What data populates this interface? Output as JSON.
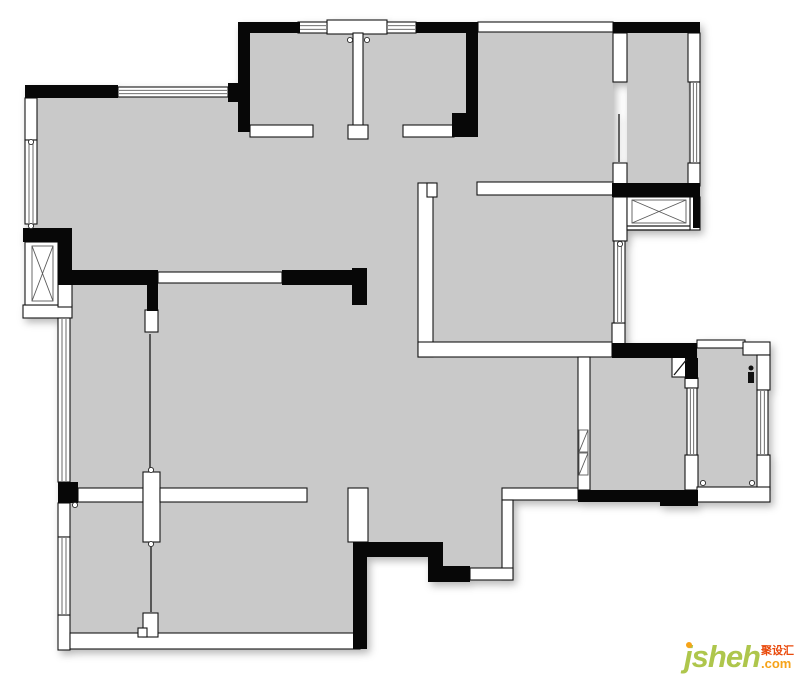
{
  "watermark": {
    "brand": "jsheh",
    "cjk": "聚设汇",
    "tld": ".com",
    "brand_color": "#aec64c",
    "cjk_color": "#e94a0c",
    "tld_color": "#f6a318",
    "dot_color": "#f6a318"
  },
  "floorplan": {
    "canvas": {
      "w": 800,
      "h": 674
    },
    "colors": {
      "floor": "#c9c9c9",
      "wall_black": "#070707",
      "wall_white": "#ffffff",
      "outline": "#161616"
    },
    "floors": [
      [
        250,
        33,
        216,
        104
      ],
      [
        478,
        30,
        135,
        153
      ],
      [
        627,
        33,
        61,
        152
      ],
      [
        31,
        92,
        582,
        193
      ],
      [
        70,
        285,
        297,
        350
      ],
      [
        367,
        285,
        211,
        215
      ],
      [
        367,
        500,
        76,
        42
      ],
      [
        443,
        500,
        59,
        68
      ],
      [
        578,
        285,
        35,
        72
      ],
      [
        590,
        357,
        107,
        133
      ],
      [
        698,
        348,
        59,
        139
      ]
    ],
    "white_walls": [
      [
        327,
        20,
        60,
        14
      ],
      [
        353,
        33,
        10,
        94
      ],
      [
        348,
        125,
        20,
        14
      ],
      [
        250,
        125,
        63,
        12
      ],
      [
        403,
        125,
        51,
        12
      ],
      [
        478,
        22,
        135,
        10
      ],
      [
        613,
        33,
        14,
        49
      ],
      [
        613,
        163,
        14,
        23
      ],
      [
        688,
        33,
        12,
        49
      ],
      [
        688,
        163,
        12,
        23
      ],
      [
        613,
        197,
        14,
        44
      ],
      [
        690,
        197,
        10,
        33
      ],
      [
        612,
        323,
        13,
        21
      ],
      [
        477,
        182,
        136,
        13
      ],
      [
        418,
        183,
        15,
        174
      ],
      [
        427,
        183,
        10,
        14
      ],
      [
        418,
        342,
        194,
        15
      ],
      [
        25,
        98,
        12,
        42
      ],
      [
        23,
        305,
        49,
        13
      ],
      [
        58,
        277,
        14,
        30
      ],
      [
        58,
        503,
        12,
        34
      ],
      [
        58,
        615,
        12,
        35
      ],
      [
        70,
        633,
        290,
        16
      ],
      [
        78,
        488,
        65,
        14
      ],
      [
        143,
        472,
        17,
        70
      ],
      [
        145,
        310,
        13,
        22
      ],
      [
        160,
        488,
        147,
        14
      ],
      [
        158,
        272,
        124,
        11
      ],
      [
        143,
        613,
        15,
        24
      ],
      [
        138,
        628,
        9,
        9
      ],
      [
        348,
        488,
        20,
        54
      ],
      [
        502,
        488,
        76,
        12
      ],
      [
        502,
        500,
        11,
        80
      ],
      [
        470,
        568,
        43,
        12
      ],
      [
        578,
        357,
        12,
        133
      ],
      [
        697,
        340,
        48,
        8
      ],
      [
        743,
        342,
        27,
        13
      ],
      [
        757,
        355,
        13,
        35
      ],
      [
        757,
        455,
        13,
        35
      ],
      [
        685,
        455,
        13,
        35
      ],
      [
        685,
        378,
        13,
        10
      ],
      [
        697,
        487,
        73,
        15
      ],
      [
        672,
        357,
        16,
        20
      ]
    ],
    "windows": [
      [
        118,
        87,
        110,
        10
      ],
      [
        298,
        22,
        29,
        11
      ],
      [
        387,
        22,
        29,
        11
      ],
      [
        25,
        140,
        12,
        84
      ],
      [
        58,
        318,
        12,
        164
      ],
      [
        58,
        537,
        12,
        78
      ],
      [
        690,
        82,
        10,
        81
      ],
      [
        614,
        241,
        11,
        82
      ],
      [
        687,
        388,
        10,
        67
      ],
      [
        757,
        390,
        11,
        65
      ]
    ],
    "xboxes": [
      {
        "outer": [
          25,
          242,
          33,
          63
        ],
        "inner": [
          32,
          246,
          21,
          55
        ]
      },
      {
        "outer": [
          627,
          197,
          63,
          33
        ],
        "inner": [
          632,
          200,
          54,
          23
        ]
      }
    ],
    "hatches": [
      [
        579,
        430,
        9,
        22
      ],
      [
        579,
        453,
        9,
        22
      ]
    ],
    "black_walls": [
      [
        25,
        85,
        93,
        13
      ],
      [
        228,
        83,
        22,
        19
      ],
      [
        238,
        22,
        12,
        110
      ],
      [
        238,
        22,
        62,
        11
      ],
      [
        416,
        22,
        62,
        11
      ],
      [
        466,
        22,
        12,
        115
      ],
      [
        452,
        113,
        26,
        24
      ],
      [
        613,
        22,
        87,
        11
      ],
      [
        693,
        195,
        7,
        33
      ],
      [
        612,
        183,
        88,
        14
      ],
      [
        612,
        343,
        85,
        15
      ],
      [
        685,
        358,
        13,
        21
      ],
      [
        578,
        490,
        120,
        12
      ],
      [
        660,
        490,
        38,
        16
      ],
      [
        23,
        228,
        49,
        14
      ],
      [
        58,
        240,
        14,
        38
      ],
      [
        58,
        270,
        100,
        15
      ],
      [
        282,
        270,
        85,
        15
      ],
      [
        352,
        268,
        15,
        37
      ],
      [
        147,
        285,
        11,
        26
      ],
      [
        58,
        482,
        20,
        21
      ],
      [
        355,
        542,
        88,
        15
      ],
      [
        428,
        557,
        15,
        25
      ],
      [
        428,
        566,
        42,
        16
      ],
      [
        353,
        542,
        14,
        107
      ]
    ],
    "lines": [
      [
        619,
        114,
        619,
        162
      ],
      [
        150,
        334,
        150,
        468
      ],
      [
        151,
        546,
        151,
        612
      ],
      [
        674,
        375,
        687,
        359
      ],
      [
        627,
        226,
        690,
        226
      ],
      [
        627,
        230,
        690,
        230
      ]
    ],
    "circles": [
      [
        31,
        142
      ],
      [
        31,
        226
      ],
      [
        350,
        40
      ],
      [
        367,
        40
      ],
      [
        620,
        244
      ],
      [
        75,
        505
      ],
      [
        151,
        470
      ],
      [
        151,
        544
      ],
      [
        703,
        483
      ],
      [
        752,
        483
      ]
    ],
    "marks": [
      [
        748,
        372,
        6,
        11
      ]
    ],
    "dots": [
      [
        751,
        368
      ]
    ]
  }
}
